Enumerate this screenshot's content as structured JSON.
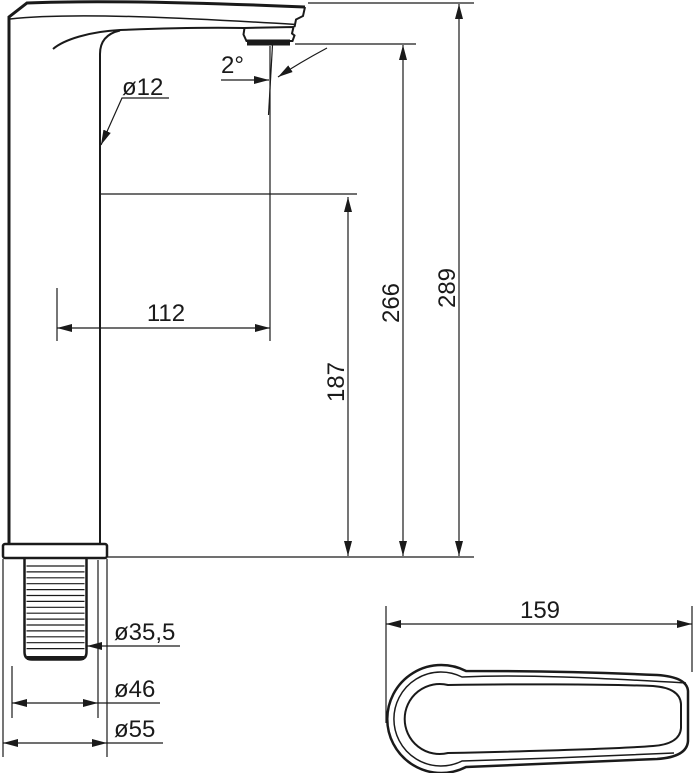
{
  "drawing": {
    "labels": {
      "spout_pipe_diameter": "ø12",
      "outlet_angle": "2°",
      "spout_reach": "112",
      "outlet_height": "187",
      "aerator_height": "266",
      "overall_height": "289",
      "thread_diameter": "ø35,5",
      "body_diameter": "ø46",
      "base_diameter": "ø55",
      "handle_length": "159"
    },
    "colors": {
      "line": "#1a1a1a",
      "background": "#ffffff"
    }
  }
}
